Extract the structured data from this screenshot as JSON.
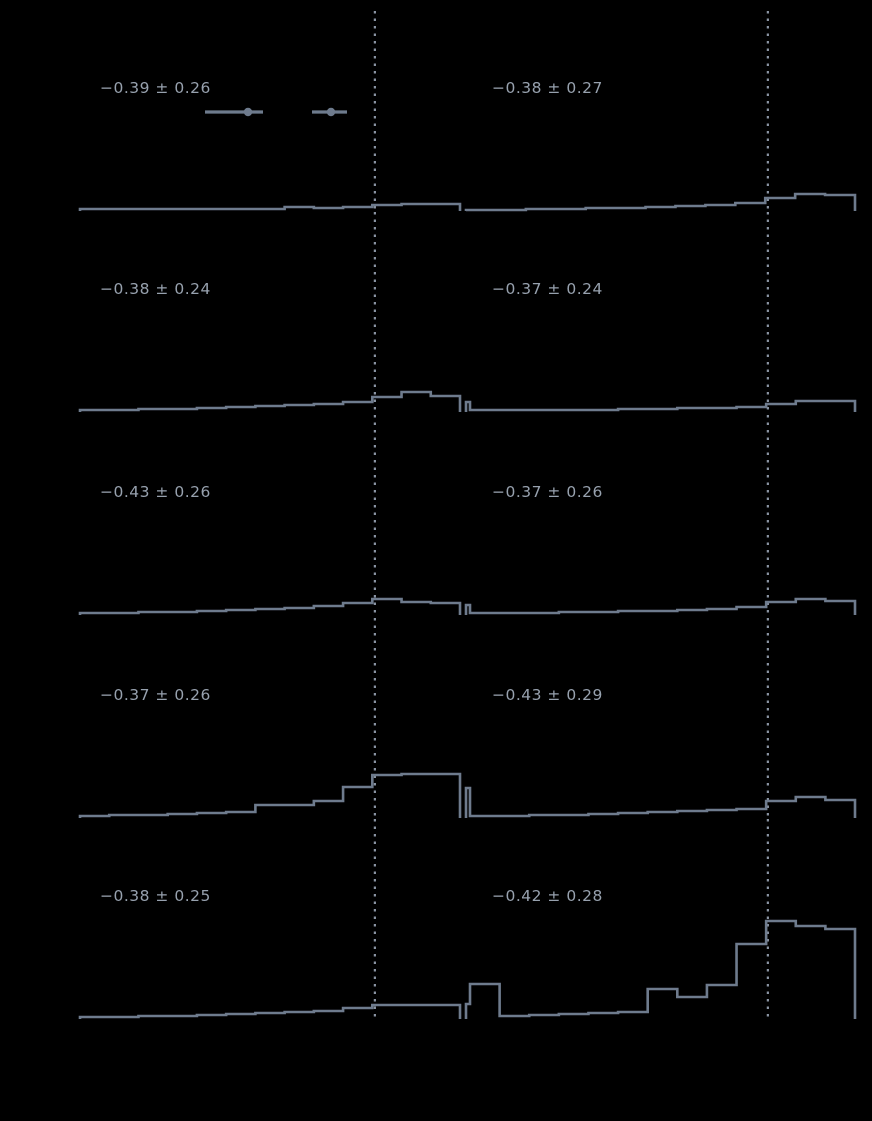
{
  "figure": {
    "background": "#000000",
    "hist_color": "#6e7b8d",
    "vline_color": "#8a94a3",
    "text_color": "#97a1ae",
    "marker_color": "#6e7b8d"
  },
  "chart_data": {
    "type": "bar",
    "subtype": "step-histogram-grid",
    "rows": 5,
    "cols": 2,
    "grid": false,
    "axes_visible": false,
    "vline_style": "dotted",
    "vline_frac": 0.776,
    "panels": [
      {
        "id": "r1c1",
        "label": "−0.39 ± 0.26",
        "spike": 2,
        "bins": [
          2,
          2,
          2,
          2,
          2,
          2,
          2,
          4,
          3,
          4,
          6,
          7,
          7
        ],
        "markers": [
          {
            "x1": 125,
            "x2": 183,
            "dot": 168,
            "y": 101
          },
          {
            "x1": 232,
            "x2": 267,
            "dot": 251,
            "y": 101
          }
        ]
      },
      {
        "id": "r1c2",
        "label": "−0.38 ± 0.27",
        "spike": 2,
        "bins": [
          1,
          1,
          2,
          2,
          3,
          3,
          4,
          5,
          6,
          8,
          13,
          17,
          16
        ],
        "markers": []
      },
      {
        "id": "r2c1",
        "label": "−0.38 ± 0.24",
        "spike": 2,
        "bins": [
          2,
          2,
          3,
          3,
          4,
          5,
          6,
          7,
          8,
          10,
          15,
          20,
          16
        ],
        "markers": []
      },
      {
        "id": "r2c2",
        "label": "−0.37 ± 0.24",
        "spike": 10,
        "bins": [
          2,
          2,
          2,
          2,
          2,
          3,
          3,
          4,
          4,
          5,
          8,
          11,
          11
        ],
        "markers": []
      },
      {
        "id": "r3c1",
        "label": "−0.43 ± 0.26",
        "spike": 2,
        "bins": [
          2,
          2,
          3,
          3,
          4,
          5,
          6,
          7,
          9,
          12,
          16,
          13,
          12
        ],
        "markers": []
      },
      {
        "id": "r3c2",
        "label": "−0.37 ± 0.26",
        "spike": 10,
        "bins": [
          2,
          2,
          2,
          3,
          3,
          4,
          4,
          5,
          6,
          8,
          13,
          16,
          14
        ],
        "markers": []
      },
      {
        "id": "r4c1",
        "label": "−0.37 ± 0.26",
        "spike": 2,
        "bins": [
          2,
          3,
          3,
          4,
          5,
          6,
          13,
          13,
          17,
          31,
          43,
          44,
          44
        ],
        "markers": []
      },
      {
        "id": "r4c2",
        "label": "−0.43 ± 0.29",
        "spike": 30,
        "bins": [
          2,
          2,
          3,
          3,
          4,
          5,
          6,
          7,
          8,
          9,
          17,
          21,
          18
        ],
        "markers": []
      },
      {
        "id": "r5c1",
        "label": "−0.38 ± 0.25",
        "spike": 2,
        "bins": [
          2,
          2,
          3,
          3,
          4,
          5,
          6,
          7,
          8,
          11,
          14,
          14,
          14
        ],
        "markers": []
      },
      {
        "id": "r5c2",
        "label": "−0.42 ± 0.28",
        "spike": 15,
        "bins": [
          35,
          3,
          4,
          5,
          6,
          7,
          30,
          22,
          34,
          75,
          98,
          93,
          90
        ],
        "markers": []
      }
    ]
  }
}
